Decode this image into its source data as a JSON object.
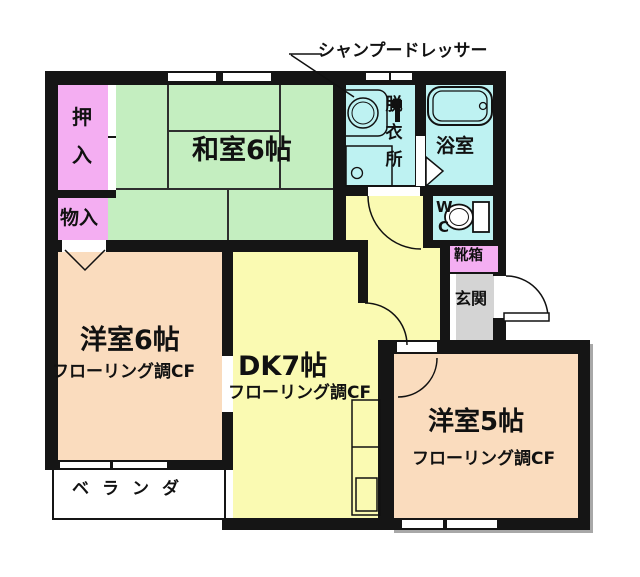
{
  "title": "間取り図",
  "colors": {
    "wall": "#151515",
    "tatami": "#c4eec0",
    "closet": "#f4aef2",
    "wet": "#bef2f2",
    "dk": "#fafab2",
    "western": "#fadcbe",
    "entry": "#d4d4d4",
    "shadow": "#a8a8a8"
  },
  "callout": {
    "label": "シャンプードレッサー"
  },
  "rooms": {
    "washitsu": {
      "name": "和室6帖"
    },
    "oshiire": {
      "name": "押入"
    },
    "monoire": {
      "name": "物入"
    },
    "datsuijo": {
      "name": "脱衣所"
    },
    "yokushitsu": {
      "name": "浴室"
    },
    "wc": {
      "name": "WC"
    },
    "kutsubako": {
      "name": "靴箱"
    },
    "genkan": {
      "name": "玄関"
    },
    "yoshitsu6": {
      "name": "洋室6帖",
      "sub": "フローリング調CF"
    },
    "dk": {
      "name": "DK7帖",
      "sub": "フローリング調CF"
    },
    "yoshitsu5": {
      "name": "洋室5帖",
      "sub": "フローリング調CF"
    },
    "veranda": {
      "name": "ベランダ"
    }
  },
  "icons": {
    "bathtub": "bathtub-icon",
    "sink": "shampoo-dresser-sink-icon",
    "washer": "washing-machine-icon",
    "toilet": "toilet-icon",
    "kitchen": "kitchen-counter-icon"
  }
}
